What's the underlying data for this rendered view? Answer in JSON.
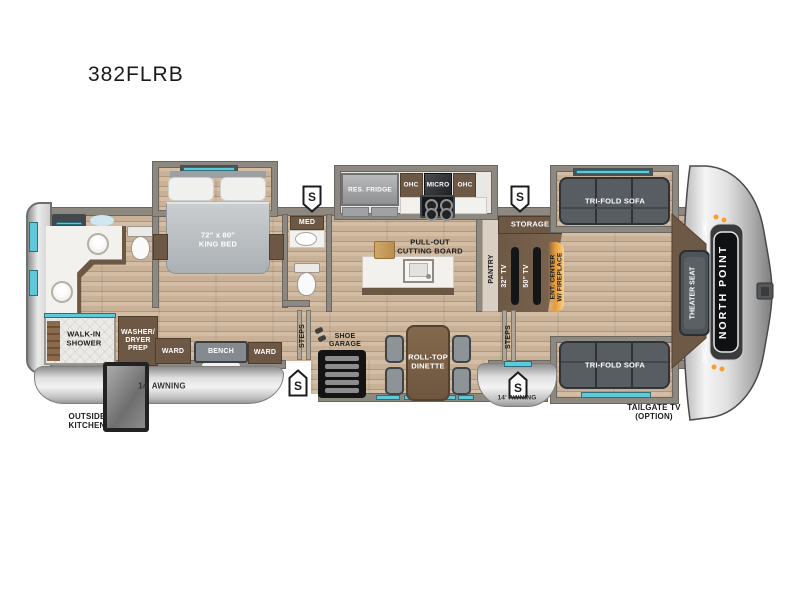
{
  "title": "382FLRB",
  "badge": "NORTH POINT",
  "rooms": {
    "shower": "WALK-IN\nSHOWER",
    "washer": "WASHER/\nDRYER\nPREP",
    "ward": "WARD",
    "bench": "BENCH",
    "king_bed": "72\" x 80\"\nKING BED",
    "med": "MED",
    "steps": "STEPS",
    "shoe_garage": "SHOE\nGARAGE",
    "res_fridge": "RES. FRIDGE",
    "ohc": "OHC",
    "micro": "MICRO",
    "cutting_board": "PULL-OUT\nCUTTING BOARD",
    "dinette": "ROLL-TOP\nDINETTE",
    "pantry": "PANTRY",
    "storage": "STORAGE",
    "tv_32": "32\" TV",
    "tv_50": "50\" TV",
    "ent_center": "ENT. CENTER\nW/ FIREPLACE",
    "sofa": "TRI-FOLD SOFA",
    "theater_seat": "THEATER SEAT"
  },
  "exterior": {
    "awning": "14' AWNING",
    "outside_kitchen": "OUTSIDE\nKITCHEN",
    "tailgate_tv": "TAILGATE TV\n(OPTION)",
    "safety_marker": "S"
  },
  "colors": {
    "accent_teal": "#5fc9d9",
    "wood_dark": "#6d5846",
    "fireplace_orange": "#f2a13a",
    "floor_tan": "#c9b299",
    "wall_gray": "#8d8880",
    "sofa_gray": "#585d61",
    "badge_black": "#121316"
  }
}
